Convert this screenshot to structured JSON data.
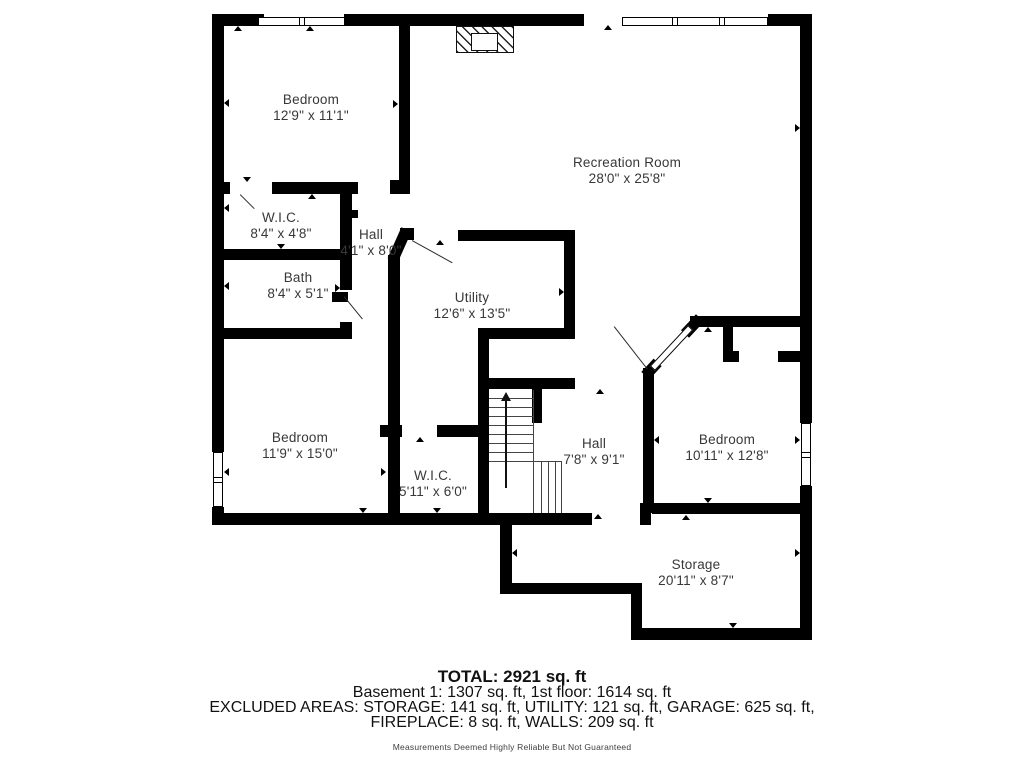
{
  "footer": {
    "total": "TOTAL: 2921 sq. ft",
    "line1": "Basement 1: 1307 sq. ft, 1st floor: 1614 sq. ft",
    "line2": "EXCLUDED AREAS: STORAGE: 141 sq. ft, UTILITY: 121 sq. ft, GARAGE: 625 sq. ft,",
    "line3": "FIREPLACE: 8 sq. ft, WALLS: 209 sq. ft",
    "disclaimer": "Measurements Deemed Highly Reliable But Not Guaranteed"
  },
  "colors": {
    "wall": "#000000",
    "room_text": "#383838",
    "footer_text": "#111111",
    "disclaimer_text": "#3f3f3f",
    "background": "#ffffff"
  },
  "plan": {
    "rooms": [
      {
        "name": "Bedroom",
        "dims": "12'9\" x 11'1\"",
        "cx": 311,
        "cy": 100
      },
      {
        "name": "Recreation Room",
        "dims": "28'0\" x 25'8\"",
        "cx": 627,
        "cy": 163
      },
      {
        "name": "W.I.C.",
        "dims": "8'4\" x 4'8\"",
        "cx": 281,
        "cy": 218
      },
      {
        "name": "Hall",
        "dims": "4'1\" x 8'0\"",
        "cx": 371,
        "cy": 235
      },
      {
        "name": "Bath",
        "dims": "8'4\" x 5'1\"",
        "cx": 298,
        "cy": 278
      },
      {
        "name": "Utility",
        "dims": "12'6\" x 13'5\"",
        "cx": 472,
        "cy": 298
      },
      {
        "name": "Bedroom",
        "dims": "11'9\" x 15'0\"",
        "cx": 300,
        "cy": 438
      },
      {
        "name": "W.I.C.",
        "dims": "5'11\" x 6'0\"",
        "cx": 433,
        "cy": 476
      },
      {
        "name": "Hall",
        "dims": "7'8\" x 9'1\"",
        "cx": 594,
        "cy": 444
      },
      {
        "name": "Bedroom",
        "dims": "10'11\" x 12'8\"",
        "cx": 727,
        "cy": 440
      },
      {
        "name": "Storage",
        "dims": "20'11\" x 8'7\"",
        "cx": 696,
        "cy": 565
      }
    ],
    "walls": [
      [
        212,
        14,
        52,
        12
      ],
      [
        344,
        14,
        240,
        12
      ],
      [
        768,
        14,
        44,
        12
      ],
      [
        212,
        14,
        12,
        438
      ],
      [
        212,
        507,
        12,
        18
      ],
      [
        800,
        14,
        12,
        409
      ],
      [
        800,
        486,
        12,
        154
      ],
      [
        212,
        513,
        380,
        12
      ],
      [
        640,
        503,
        11,
        22
      ],
      [
        652,
        503,
        160,
        11
      ],
      [
        500,
        525,
        12,
        64
      ],
      [
        500,
        583,
        142,
        11
      ],
      [
        631,
        594,
        11,
        46
      ],
      [
        631,
        628,
        181,
        12
      ],
      [
        399,
        26,
        11,
        156
      ],
      [
        390,
        180,
        20,
        14
      ],
      [
        212,
        182,
        18,
        12
      ],
      [
        272,
        182,
        86,
        12
      ],
      [
        340,
        182,
        12,
        108
      ],
      [
        352,
        210,
        6,
        8
      ],
      [
        340,
        322,
        12,
        16
      ],
      [
        212,
        249,
        140,
        11
      ],
      [
        212,
        328,
        140,
        11
      ],
      [
        388,
        255,
        12,
        258
      ],
      [
        332,
        292,
        16,
        10
      ],
      [
        400,
        228,
        14,
        12
      ],
      [
        458,
        230,
        114,
        11
      ],
      [
        564,
        230,
        11,
        107
      ],
      [
        478,
        328,
        97,
        11
      ],
      [
        478,
        378,
        97,
        11
      ],
      [
        478,
        328,
        11,
        185
      ],
      [
        532,
        389,
        10,
        34
      ],
      [
        380,
        425,
        22,
        12
      ],
      [
        437,
        425,
        43,
        12
      ],
      [
        643,
        368,
        11,
        145
      ],
      [
        690,
        316,
        110,
        11
      ],
      [
        723,
        327,
        10,
        26
      ],
      [
        723,
        351,
        16,
        11
      ],
      [
        778,
        351,
        22,
        11
      ]
    ],
    "diagonal_walls": [
      {
        "x": 394,
        "y": 228,
        "w": 11,
        "h": 34,
        "rot": 24
      },
      {
        "x": 687,
        "y": 315,
        "w": 11,
        "h": 22,
        "rot": 43
      },
      {
        "x": 646,
        "y": 360,
        "w": 11,
        "h": 18,
        "rot": 43
      }
    ],
    "open_door": {
      "x": 668,
      "y": 320,
      "w": 7,
      "h": 56,
      "rot": 43
    },
    "windows": [
      {
        "x": 258,
        "y": 17,
        "w": 87,
        "h": 9,
        "orient": "h",
        "dividers": [
          299,
          304
        ]
      },
      {
        "x": 622,
        "y": 17,
        "w": 146,
        "h": 9,
        "orient": "h",
        "dividers": [
          672,
          677,
          719,
          724
        ]
      },
      {
        "x": 213,
        "y": 452,
        "w": 10,
        "h": 55,
        "orient": "v",
        "dividers": [
          477,
          482
        ]
      },
      {
        "x": 801,
        "y": 423,
        "w": 10,
        "h": 63,
        "orient": "v",
        "dividers": [
          452,
          457
        ]
      }
    ],
    "fireplace": {
      "outer": {
        "x": 456,
        "y": 26,
        "w": 58,
        "h": 27
      },
      "inner": {
        "x": 471,
        "y": 33,
        "w": 27,
        "h": 18
      }
    },
    "stairs": {
      "shaft": {
        "x": 489,
        "w": 45
      },
      "treads_y": [
        398,
        407,
        416,
        425,
        434,
        443,
        452,
        461
      ],
      "right_edge": {
        "x": 533,
        "y1": 390,
        "y2": 513
      },
      "turn_vlines_x": [
        541,
        548,
        555
      ],
      "turn": {
        "y1": 461,
        "y2": 513,
        "x2": 561
      },
      "arrow": {
        "x": 505,
        "y1": 401,
        "y2": 488
      }
    },
    "door_leaves": [
      {
        "x": 412,
        "y": 240,
        "len": 46,
        "rot": 29
      },
      {
        "x": 344,
        "y": 296,
        "len": 29,
        "rot": 51
      },
      {
        "x": 240,
        "y": 194,
        "len": 20,
        "rot": 45
      },
      {
        "x": 614,
        "y": 326,
        "len": 54,
        "rot": 52
      }
    ],
    "ticks": [
      [
        238,
        26,
        "up"
      ],
      [
        310,
        26,
        "up"
      ],
      [
        224,
        103,
        "left"
      ],
      [
        398,
        104,
        "right"
      ],
      [
        608,
        25,
        "up"
      ],
      [
        800,
        128,
        "right"
      ],
      [
        247,
        182,
        "down"
      ],
      [
        312,
        194,
        "up"
      ],
      [
        224,
        208,
        "left"
      ],
      [
        281,
        249,
        "down"
      ],
      [
        224,
        286,
        "left"
      ],
      [
        340,
        288,
        "right"
      ],
      [
        440,
        240,
        "up"
      ],
      [
        564,
        292,
        "right"
      ],
      [
        224,
        472,
        "left"
      ],
      [
        363,
        513,
        "down"
      ],
      [
        437,
        513,
        "down"
      ],
      [
        386,
        472,
        "right"
      ],
      [
        420,
        437,
        "up"
      ],
      [
        600,
        389,
        "up"
      ],
      [
        654,
        440,
        "left"
      ],
      [
        708,
        327,
        "up"
      ],
      [
        708,
        503,
        "down"
      ],
      [
        686,
        515,
        "up"
      ],
      [
        800,
        440,
        "right"
      ],
      [
        598,
        514,
        "up"
      ],
      [
        733,
        628,
        "down"
      ],
      [
        512,
        553,
        "left"
      ],
      [
        800,
        553,
        "right"
      ]
    ]
  }
}
